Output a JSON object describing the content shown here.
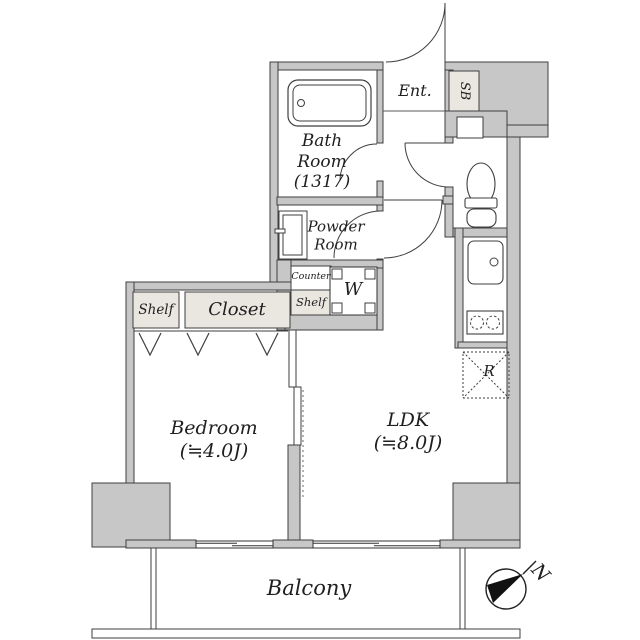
{
  "rooms": {
    "bath": {
      "label": "Bath\nRoom\n(1317)"
    },
    "entrance": {
      "label": "Ent."
    },
    "shoe_box": {
      "label": "SB"
    },
    "powder": {
      "label": "Powder\nRoom"
    },
    "counter": {
      "label": "Counter"
    },
    "laundry_shelf": {
      "label": "Shelf"
    },
    "washer": {
      "label": "W"
    },
    "shelf": {
      "label": "Shelf"
    },
    "closet": {
      "label": "Closet"
    },
    "bedroom": {
      "label": "Bedroom\n(≒4.0J)"
    },
    "ldk": {
      "label": "LDK\n(≒8.0J)"
    },
    "refrigerator": {
      "label": "R"
    },
    "balcony": {
      "label": "Balcony"
    }
  },
  "compass": {
    "north_label": "N"
  },
  "colors": {
    "wall_fill": "#c7c7c7",
    "wall_outline": "#3f3f3f",
    "cabinet_fill": "#eae7e1",
    "text": "#1f1f1f",
    "background": "#ffffff"
  },
  "icons": [
    "bathtub-icon",
    "washbasin-icon",
    "toilet-icon",
    "kitchen-sink-icon",
    "stove-icon",
    "washer-pan-icon",
    "refrigerator-icon",
    "door-arc-icon",
    "sliding-door-icon",
    "folding-door-icon",
    "window-icon",
    "compass-icon"
  ]
}
